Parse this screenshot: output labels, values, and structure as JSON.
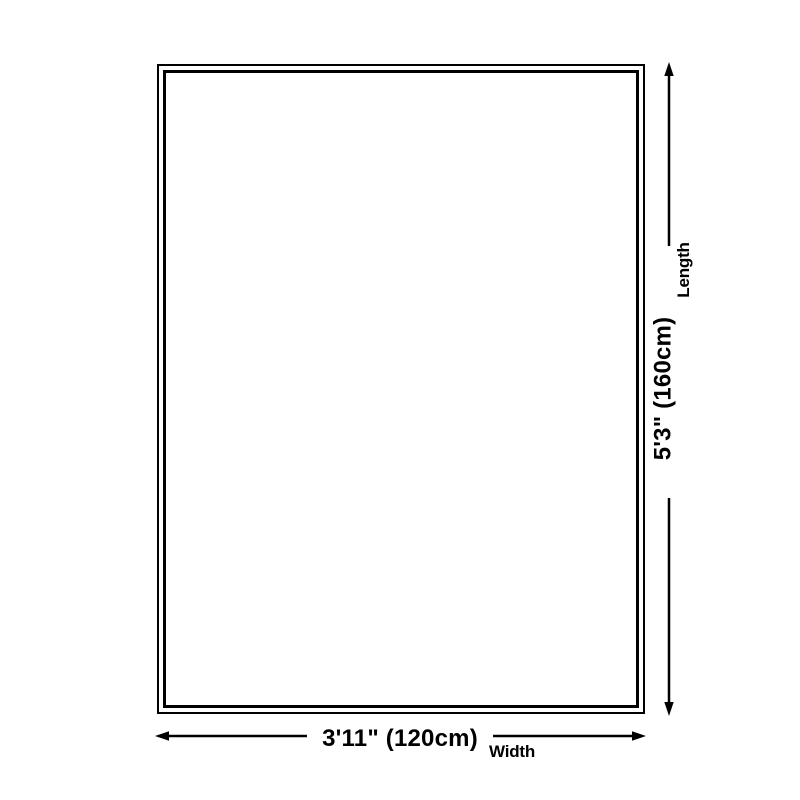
{
  "diagram": {
    "type": "product-dimension-diagram",
    "colors": {
      "background": "#ffffff",
      "line": "#000000",
      "text": "#000000"
    },
    "dimensions": {
      "length": {
        "value": "5'3\" (160cm)",
        "label": "Length"
      },
      "width": {
        "value": "3'11\" (120cm)",
        "label": "Width"
      }
    }
  }
}
